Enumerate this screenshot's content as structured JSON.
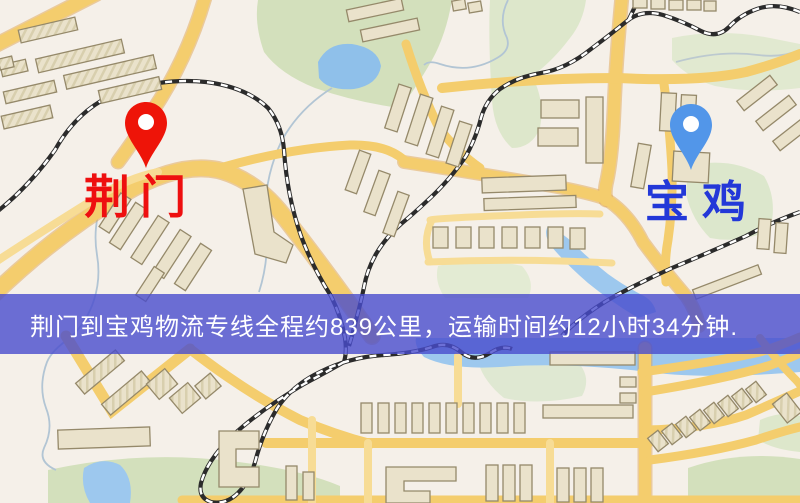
{
  "map": {
    "markers": {
      "origin": {
        "name": "荆门",
        "pin_color": "#ee1408",
        "pin_hole_color": "#ffffff",
        "label_color": "#ee0f0f"
      },
      "destination": {
        "name": "宝鸡",
        "pin_color": "#5296e9",
        "pin_hole_color": "#ffffff",
        "label_color": "#2338d8"
      }
    },
    "banner": {
      "text": "荆门到宝鸡物流专线全程约839公里，运输时间约12小时34分钟.",
      "background": "rgba(72,76,205,0.8)",
      "text_color": "#ffffff"
    },
    "route": {
      "origin": "荆门",
      "destination": "宝鸡",
      "distance": "约839公里",
      "duration": "约12小时34分钟"
    },
    "palette": {
      "background": "#f5f0e9",
      "road": "#f4cd6d",
      "road_minor": "#f7dc95",
      "road_casing": "#dfa450",
      "park": "#d3e0bc",
      "park_pale": "#e1e9d0",
      "water": "#9dc8ee",
      "building_fill": "#eae2cb",
      "building_stroke": "#95896a",
      "railway_dark": "#2b2b2b",
      "railway_light": "#ffffff"
    }
  }
}
